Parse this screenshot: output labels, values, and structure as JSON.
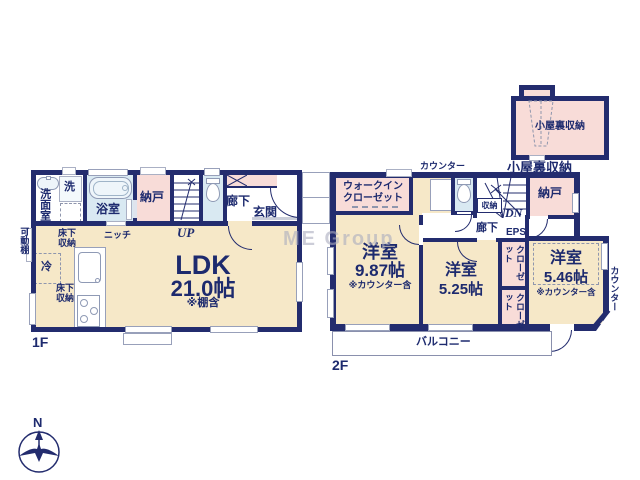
{
  "watermark": "ME Group",
  "compass": {
    "north": "N"
  },
  "floor1": {
    "label": "1F",
    "washroom": "洗面室",
    "washer": "洗",
    "bathroom": "浴室",
    "storage": "納戸",
    "stairs": "UP",
    "hallway": "廊下",
    "entrance": "玄関",
    "ldk_name": "LDK",
    "ldk_size": "21.0帖",
    "ldk_note": "※棚含",
    "movable_shelf": "可動棚",
    "underfloor_storage_1": "床下収納",
    "niche": "ニッチ",
    "fridge": "冷",
    "underfloor_storage_2": "床下収納"
  },
  "floor2": {
    "label": "2F",
    "attic_storage_inner": "小屋裏収納",
    "attic_storage_caption": "小屋裏収納",
    "counter_top": "カウンター",
    "walk_in_closet": "ウォークインクローゼット",
    "storage_small": "収納",
    "stairs": "DN",
    "storage": "納戸",
    "hallway": "廊下",
    "eps": "EPS",
    "room1_name": "洋室",
    "room1_size": "9.87帖",
    "room1_note": "※カウンター含",
    "room2_name": "洋室",
    "room2_size": "5.25帖",
    "room3_name": "洋室",
    "room3_size": "5.46帖",
    "room3_note": "※カウンター含",
    "closet1": "クローゼット",
    "closet2": "クローゼット",
    "counter_right": "カウンター",
    "balcony": "バルコニー"
  }
}
